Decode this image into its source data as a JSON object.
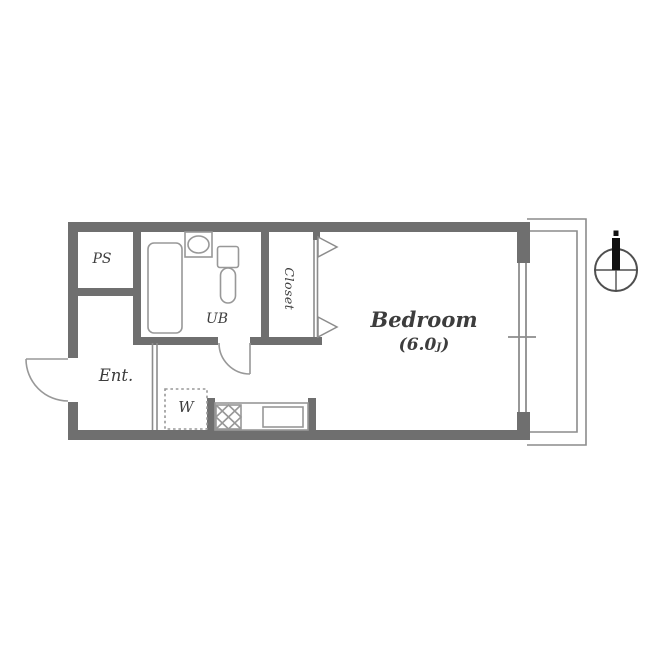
{
  "figure": {
    "type": "apartment-floor-plan"
  },
  "labels": {
    "ps": "PS",
    "ub": "UB",
    "closet": "Closet",
    "bedroom": "Bedroom",
    "bedroom_size_open": "(6.0",
    "bedroom_size_unit": "J",
    "bedroom_size_close": ")",
    "entrance": "Ent.",
    "washer": "W"
  },
  "colors": {
    "wall": "#6f6f6f",
    "line": "#8c8c8c",
    "fixture": "#989898",
    "text": "#3d3d3d",
    "compass_needle": "#111111",
    "background": "#ffffff"
  },
  "icons": {
    "compass": "north-compass-icon"
  },
  "fixtures": [
    "bathtub",
    "wash-basin",
    "toilet",
    "folding-closet-door",
    "entrance-door",
    "bathroom-door",
    "washing-machine-space",
    "stove",
    "kitchen-sink",
    "sliding-window",
    "balcony"
  ]
}
